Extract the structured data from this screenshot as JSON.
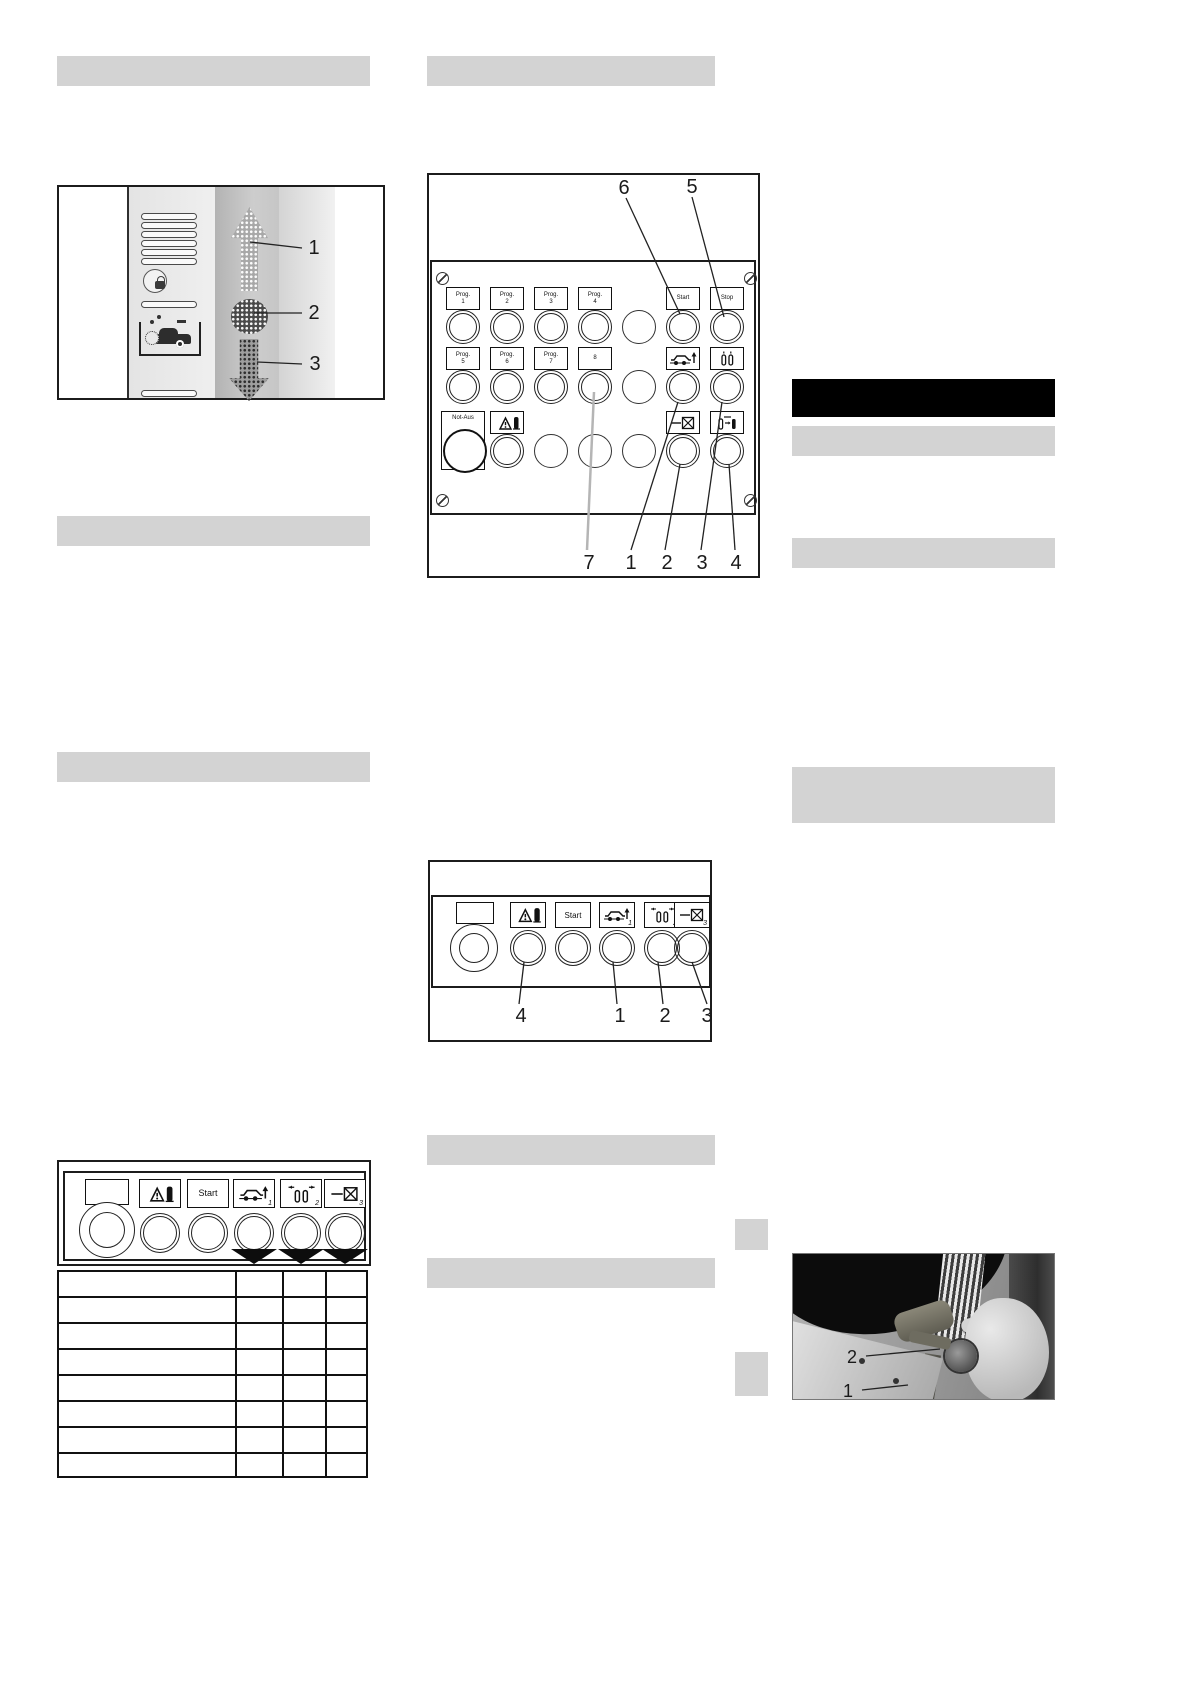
{
  "colors": {
    "placeholder_bar": "#d3d3d3",
    "black_bar": "#000000",
    "line": "#1c1c1c"
  },
  "figures": {
    "station_column": {
      "callout_1": "1",
      "callout_2": "2",
      "callout_3": "3"
    },
    "control_panel": {
      "prog_prefix": "Prog.",
      "prog1": "1",
      "prog2": "2",
      "prog3": "3",
      "prog4": "4",
      "prog5": "5",
      "prog6": "6",
      "prog7": "7",
      "button_8": "8",
      "start": "Start",
      "stop": "Stop",
      "emergency": "Not-Aus",
      "callout_top_start": "6",
      "callout_top_stop": "5",
      "callout_b_7": "7",
      "callout_b_1": "1",
      "callout_b_2": "2",
      "callout_b_3": "3",
      "callout_b_4": "4"
    },
    "service_panel": {
      "start": "Start",
      "sub_car": "1",
      "sub_gantry": "2",
      "sub_wash": "3",
      "callout_warning": "4",
      "callout_car": "1",
      "callout_gantry": "2",
      "callout_wash": "3"
    },
    "manual_panel": {
      "start": "Start",
      "sub_car": "1",
      "sub_gantry": "2",
      "sub_wash": "3"
    },
    "photo": {
      "callout_2": "2",
      "callout_1": "1"
    }
  }
}
